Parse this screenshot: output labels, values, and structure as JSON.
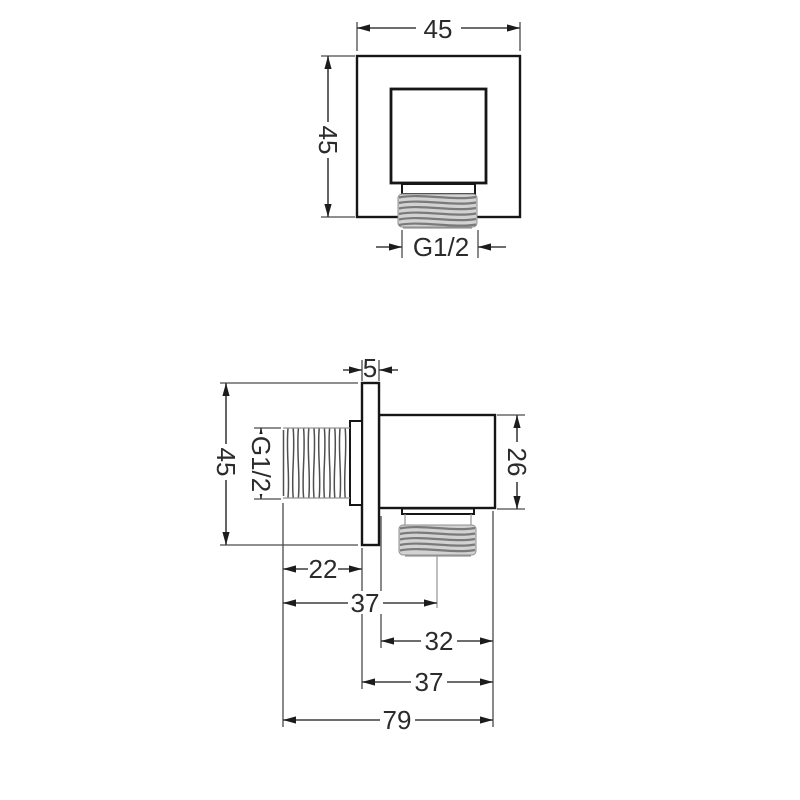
{
  "drawing": {
    "front_view": {
      "width": "45",
      "height": "45",
      "thread": "G1/2"
    },
    "side_view": {
      "plate_thickness": "5",
      "height": "45",
      "thread": "G1/2",
      "body_height": "26",
      "thread_length": "22",
      "outlet_center_offset": "37",
      "body_width": "32",
      "body_depth": "37",
      "total_depth": "79"
    }
  }
}
